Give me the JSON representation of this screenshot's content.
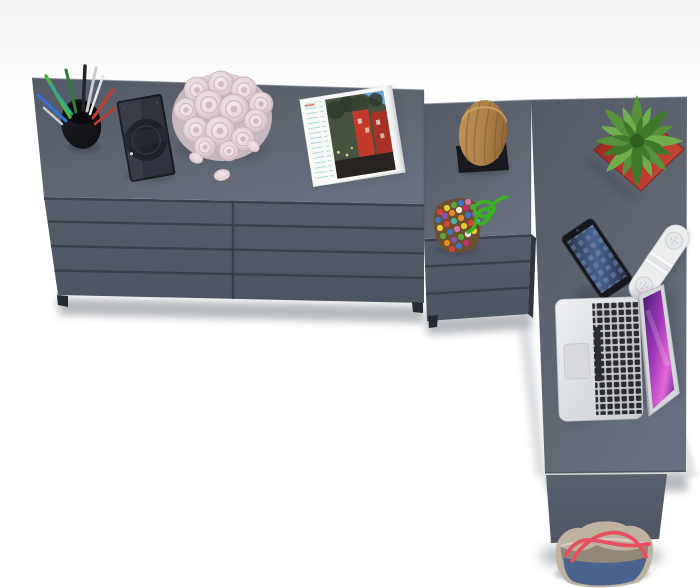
{
  "scene": {
    "type": "product-photo",
    "description": "Overhead studio view of an anthracite gray L-shaped corner desk with an eight-drawer dresser and a three-drawer pedestal, styled with office and decor accessories on a white background",
    "background": "#ffffff",
    "backdrop_tint": "#f1f2f3"
  },
  "colors": {
    "desk_top": "#5e6570",
    "desk_top_dark": "#535a67",
    "desk_top_light": "#687080",
    "drawer_front": "#4d5462",
    "groove": "#363c48",
    "leg_panel": "#59606d",
    "shadow": "#70767e",
    "pot_red": "#b5362b",
    "pot_red_dark": "#8f2a20",
    "leaf_green": "#55923a",
    "leaf_green_light": "#6fae4b",
    "leaf_green_dark": "#3f7a2b",
    "rose_pink": "#e8d9dd",
    "rose_pink_deep": "#c9b2ba",
    "stump_wood": "#aa7f46",
    "stump_wood_dark": "#8f6536",
    "cord_green": "#3cb024",
    "bag_blue": "#4b648e",
    "bag_beige": "#bdb1a0",
    "bag_red": "#e84f62",
    "laptop_silver": "#dfe1e4",
    "screen_purple": "#9a35b5",
    "screen_magenta": "#e368d6",
    "screen_violet": "#41206f",
    "phone_black": "#16181d",
    "phone_screen": "#4a648f",
    "speaker_white": "#eceded",
    "frame_dark": "#2c303a",
    "cup_black": "#17191e",
    "magazine_red": "#c23a2a",
    "magazine_teal": "#9fd4cf",
    "pen_green": "#4db53c",
    "pen_olive": "#2e7d32",
    "pen_silver": "#c9ccd1",
    "pen_dark": "#23252a",
    "pen_blue": "#3a6fd8",
    "pen_teal": "#2fa6a0",
    "pen_red": "#c43a2e",
    "pen_white": "#e8e8ea",
    "bead_red": "#d8413c",
    "bead_orange": "#e58a2b",
    "bead_yellow": "#e7c93a",
    "bead_green": "#58a53c",
    "bead_blue": "#3e74c4",
    "bead_purple": "#8a52ac",
    "bead_pink": "#d873a8",
    "bead_white": "#ece7df",
    "bead_magenta": "#c22f6d",
    "bead_teal": "#46b0a8"
  },
  "furniture": {
    "dresser": {
      "label": "Wide anthracite dresser with eight drawers",
      "drawer_rows": 4,
      "drawer_columns": 2
    },
    "pedestal": {
      "label": "Three-drawer desk pedestal",
      "drawer_rows": 3
    },
    "desk": {
      "label": "L-shaped corner desk top with side leg panel"
    }
  },
  "objects": {
    "pencil_cup": {
      "label": "Black mesh pencil cup with colored pens"
    },
    "photo_frame": {
      "label": "Dark glass photo frame lying flat"
    },
    "rose_bouquet": {
      "label": "Bouquet of pale pink roses"
    },
    "rose_petals": {
      "label": "Three loose rose petals"
    },
    "magazine": {
      "label": "Open magazine with red building photo"
    },
    "wood_stump": {
      "label": "Decorative wooden stump on black stand"
    },
    "bead_pouch": {
      "label": "Multicolored beaded pouch with green cord"
    },
    "potted_plant": {
      "label": "Green succulent in red square pot"
    },
    "smartphone": {
      "label": "Smartphone with blue screen"
    },
    "speaker": {
      "label": "White pill-shaped portable speaker"
    },
    "laptop": {
      "label": "Open silver laptop with purple wallpaper"
    },
    "tote_bag": {
      "label": "Blue and beige tote bag with red handles on the floor"
    }
  }
}
